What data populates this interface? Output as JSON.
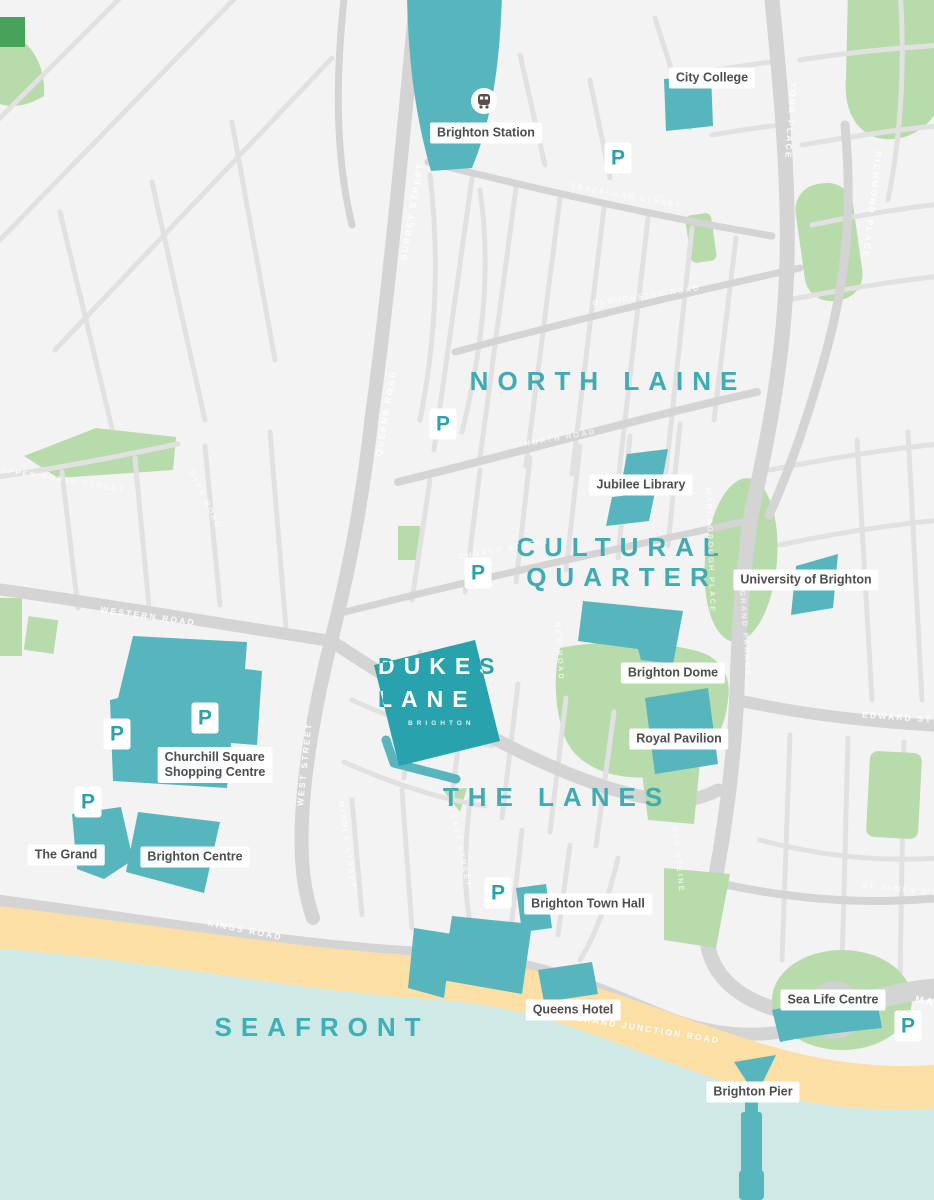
{
  "title": "Dukes Lane Brighton area map",
  "colors": {
    "background": "#f4f3f4",
    "road": "#d5d4d5",
    "road_minor": "#e2e1e2",
    "park_green": "#b7dbaa",
    "dark_green": "#47a25a",
    "building_teal": "#57b5bd",
    "logo_teal": "#28a2ac",
    "district_teal": "#3fabb3",
    "sand": "#fbdfa5",
    "sea": "#cfe9e6",
    "label_text": "#4e4e4e",
    "street_text": "#ffffff"
  },
  "logo": {
    "line1": "DUKES",
    "line2": "LANE",
    "tagline": "BRIGHTON"
  },
  "districts": {
    "north_laine": "NORTH LAINE",
    "cultural_line1": "CULTURAL",
    "cultural_line2": "QUARTER",
    "the_lanes": "THE LANES",
    "seafront": "SEAFRONT"
  },
  "landmarks": {
    "brighton_station": "Brighton Station",
    "city_college": "City College",
    "jubilee_library": "Jubilee Library",
    "university_of_brighton": "University of Brighton",
    "brighton_dome": "Brighton Dome",
    "royal_pavilion": "Royal Pavilion",
    "churchill_line1": "Churchill Square",
    "churchill_line2": "Shopping Centre",
    "the_grand": "The Grand",
    "brighton_centre": "Brighton Centre",
    "brighton_town_hall": "Brighton Town Hall",
    "queens_hotel": "Queens Hotel",
    "sea_life_centre": "Sea Life Centre",
    "brighton_pier": "Brighton Pier"
  },
  "streets": {
    "surrey_street": "SURREY STREET",
    "queens_road": "QUEENS ROAD",
    "western_road": "WESTERN ROAD",
    "west_street": "WEST STREET",
    "kings_road": "KINGS ROAD",
    "grand_junction_road": "GRAND JUNCTION ROAD",
    "york_place": "YORK PLACE",
    "richmond_place": "RICHMOND PLACE",
    "edward_street": "EDWARD ST",
    "old_steine": "OLD STEINE",
    "st_james_street": "ST JAMES'S ST",
    "upper_north_street": "UPPER NORTH STREET",
    "dyke_road": "DYKE ROAD",
    "trafalgar_street": "TRAFALGAR STREET",
    "gloucester_road": "GLOUCESTER ROAD",
    "north_road": "NORTH ROAD",
    "church_street": "CHURCH STREET",
    "new_road": "NEW ROAD",
    "marlborough_place": "MARLBOROUGH PLACE",
    "grand_parade": "GRAND PARADE",
    "middle_street": "MIDDLE STREET",
    "east_street": "EAST STREET",
    "marine_parade_fragment": "MA"
  },
  "parking_label": "P"
}
